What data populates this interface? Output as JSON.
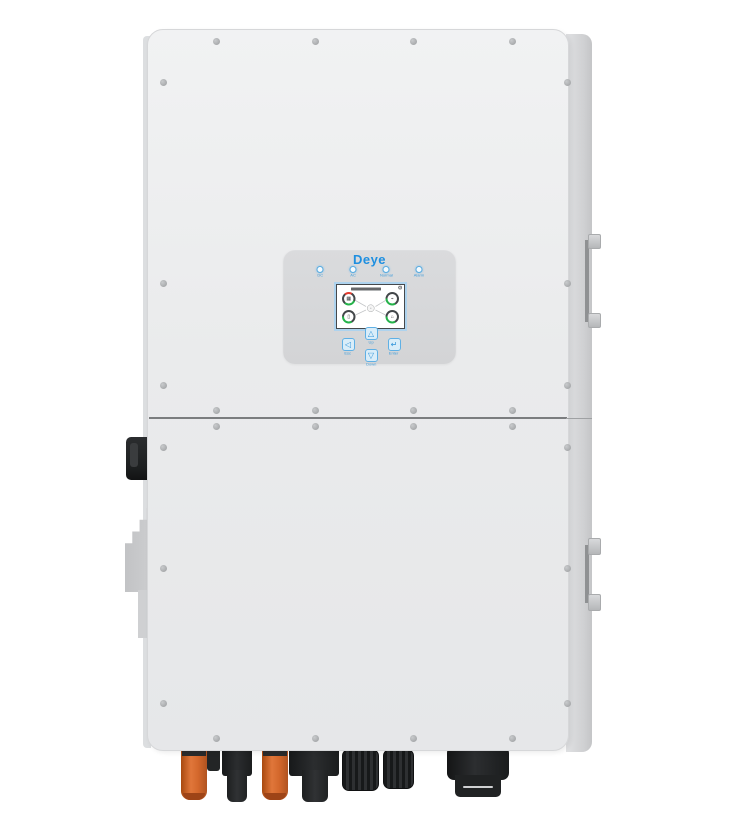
{
  "product": {
    "brand": "Deye"
  },
  "panel": {
    "logo": "Deye",
    "leds": [
      {
        "label": "DC"
      },
      {
        "label": "AC"
      },
      {
        "label": "Normal"
      },
      {
        "label": "Alarm"
      }
    ],
    "buttons": [
      {
        "label": "Esc",
        "glyph": "◁"
      },
      {
        "label": "Up",
        "glyph": "△"
      },
      {
        "label": "Down",
        "glyph": "▽"
      },
      {
        "label": "Enter",
        "glyph": "↵"
      }
    ],
    "screen": {
      "gear_glyph": "⚙",
      "gauges": [
        {
          "name": "pv-gauge",
          "glyph": "▦"
        },
        {
          "name": "grid-gauge",
          "glyph": "⌁"
        },
        {
          "name": "battery-gauge",
          "glyph": "▯"
        },
        {
          "name": "load-gauge",
          "glyph": "⌂"
        }
      ]
    }
  },
  "colors": {
    "logo_blue": "#1e8fe0",
    "accent_blue": "#5fb0e5",
    "body_gray": "#e9eaec",
    "panel_gray": "#d7d8da",
    "gauge_green": "#25b24a",
    "gauge_red": "#e23b2e",
    "connector_orange": "#d4682c"
  }
}
